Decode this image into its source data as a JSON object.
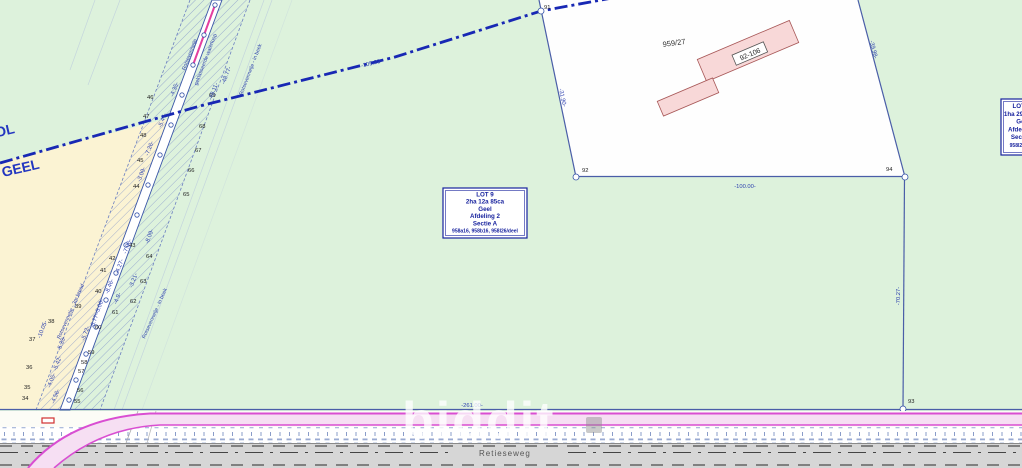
{
  "map": {
    "colors": {
      "field_green": "#ddf2dc",
      "neighbour_cream": "#fbf3d3",
      "lot_white": "#fefefe",
      "building_pink": "#f8d8d8",
      "building_stroke": "#a85858",
      "boundary_blue": "#4a5ea8",
      "municipal_blue": "#1828b4",
      "hatch_blue": "#7e90c8",
      "road_magenta": "#d94ed2",
      "road_fill": "#f6dff3",
      "road_gray": "#d6d6d6"
    },
    "labels": {
      "municipality_top": "MOL",
      "municipality_bottom": "GEEL",
      "parcel": "959/27",
      "building": "92-106",
      "road": "Retieseweg",
      "watermark": "biddit"
    },
    "lot_box": {
      "lines": [
        "LOT 9",
        "2ha 12a 85ca",
        "Geel",
        "Afdeling 2",
        "Sectie A",
        "958a16, 958b16, 958l26/deel"
      ]
    },
    "lot_box_right": {
      "lines": [
        "LOT 10",
        "1ha 29a 70ca",
        "Geel",
        "Afdeling 2",
        "Sectie A",
        "958l26/deel"
      ]
    },
    "points": [
      {
        "t": "91",
        "x": 544,
        "y": 9
      },
      {
        "t": "92",
        "x": 582,
        "y": 172
      },
      {
        "t": "93",
        "x": 908,
        "y": 403
      },
      {
        "t": "94",
        "x": 886,
        "y": 171
      },
      {
        "t": "46",
        "x": 147,
        "y": 99
      },
      {
        "t": "47",
        "x": 143,
        "y": 118
      },
      {
        "t": "48",
        "x": 140,
        "y": 137
      },
      {
        "t": "45",
        "x": 137,
        "y": 162
      },
      {
        "t": "44",
        "x": 133,
        "y": 188
      },
      {
        "t": "43",
        "x": 129,
        "y": 247
      },
      {
        "t": "42",
        "x": 109,
        "y": 260
      },
      {
        "t": "41",
        "x": 100,
        "y": 272
      },
      {
        "t": "40",
        "x": 95,
        "y": 293
      },
      {
        "t": "39",
        "x": 75,
        "y": 308
      },
      {
        "t": "38",
        "x": 48,
        "y": 323
      },
      {
        "t": "37",
        "x": 29,
        "y": 341
      },
      {
        "t": "36",
        "x": 26,
        "y": 369
      },
      {
        "t": "35",
        "x": 24,
        "y": 389
      },
      {
        "t": "34",
        "x": 22,
        "y": 400
      },
      {
        "t": "69",
        "x": 209,
        "y": 97
      },
      {
        "t": "68",
        "x": 199,
        "y": 128
      },
      {
        "t": "67",
        "x": 195,
        "y": 152
      },
      {
        "t": "66",
        "x": 188,
        "y": 172
      },
      {
        "t": "65",
        "x": 183,
        "y": 196
      },
      {
        "t": "64",
        "x": 146,
        "y": 258
      },
      {
        "t": "63",
        "x": 140,
        "y": 283
      },
      {
        "t": "62",
        "x": 130,
        "y": 303
      },
      {
        "t": "61",
        "x": 112,
        "y": 314
      },
      {
        "t": "60",
        "x": 95,
        "y": 329
      },
      {
        "t": "59",
        "x": 88,
        "y": 354
      },
      {
        "t": "58",
        "x": 81,
        "y": 364
      },
      {
        "t": "57",
        "x": 78,
        "y": 373
      },
      {
        "t": "56",
        "x": 77,
        "y": 392
      },
      {
        "t": "55",
        "x": 74,
        "y": 403
      }
    ],
    "dimensions": [
      {
        "t": "-100.00-",
        "x": 745,
        "y": 188,
        "r": 0
      },
      {
        "t": "-261.00-",
        "x": 472,
        "y": 407,
        "r": 0
      },
      {
        "t": "-70.27-",
        "x": 900,
        "y": 296,
        "r": -90
      },
      {
        "t": "-31.90-",
        "x": 561,
        "y": 98,
        "r": 78
      },
      {
        "t": "-39.98-",
        "x": 872,
        "y": 50,
        "r": 75
      },
      {
        "t": "-105.23-",
        "x": 372,
        "y": 65,
        "r": -14
      },
      {
        "t": "-48.77-",
        "x": 228,
        "y": 76,
        "r": -69
      },
      {
        "t": "-48.11-",
        "x": 215,
        "y": 92,
        "r": -69
      },
      {
        "t": "-4.35-",
        "x": 176,
        "y": 90,
        "r": -69
      },
      {
        "t": "-5.47-",
        "x": 164,
        "y": 121,
        "r": -69
      },
      {
        "t": "-7.26-",
        "x": 151,
        "y": 149,
        "r": -69
      },
      {
        "t": "-3.09-",
        "x": 143,
        "y": 175,
        "r": -69
      },
      {
        "t": "-8.09-",
        "x": 151,
        "y": 237,
        "r": -69
      },
      {
        "t": "-7.06-",
        "x": 129,
        "y": 247,
        "r": -69
      },
      {
        "t": "-4.27-",
        "x": 121,
        "y": 267,
        "r": -69
      },
      {
        "t": "-8.46-",
        "x": 111,
        "y": 287,
        "r": -69
      },
      {
        "t": "-3.21-",
        "x": 135,
        "y": 281,
        "r": -69
      },
      {
        "t": "-5.06-",
        "x": 101,
        "y": 307,
        "r": -69
      },
      {
        "t": "-4.9-",
        "x": 119,
        "y": 299,
        "r": -69
      },
      {
        "t": "-6.77-",
        "x": 96,
        "y": 321,
        "r": -69
      },
      {
        "t": "-5.72-",
        "x": 87,
        "y": 334,
        "r": -69
      },
      {
        "t": "-10.05-",
        "x": 44,
        "y": 330,
        "r": -69
      },
      {
        "t": "-5.35-",
        "x": 63,
        "y": 344,
        "r": -69
      },
      {
        "t": "-5.42-",
        "x": 59,
        "y": 364,
        "r": -69
      },
      {
        "t": "-4.05-",
        "x": 53,
        "y": 381,
        "r": -69
      },
      {
        "t": "-4.56-",
        "x": 57,
        "y": 397,
        "r": -69
      }
    ],
    "annotations": [
      {
        "t": "Rotsevennetje",
        "x": 191,
        "y": 55,
        "r": -69
      },
      {
        "t": "geklasseerde waterloop",
        "x": 207,
        "y": 60,
        "r": -69
      },
      {
        "t": "Rotsevennetje - in beek",
        "x": 252,
        "y": 70,
        "r": -69
      },
      {
        "t": "Rotsevennetje - 3m breed",
        "x": 72,
        "y": 312,
        "r": -66
      },
      {
        "t": "Rotsevennetje - in beek",
        "x": 156,
        "y": 314,
        "r": -66
      }
    ]
  }
}
